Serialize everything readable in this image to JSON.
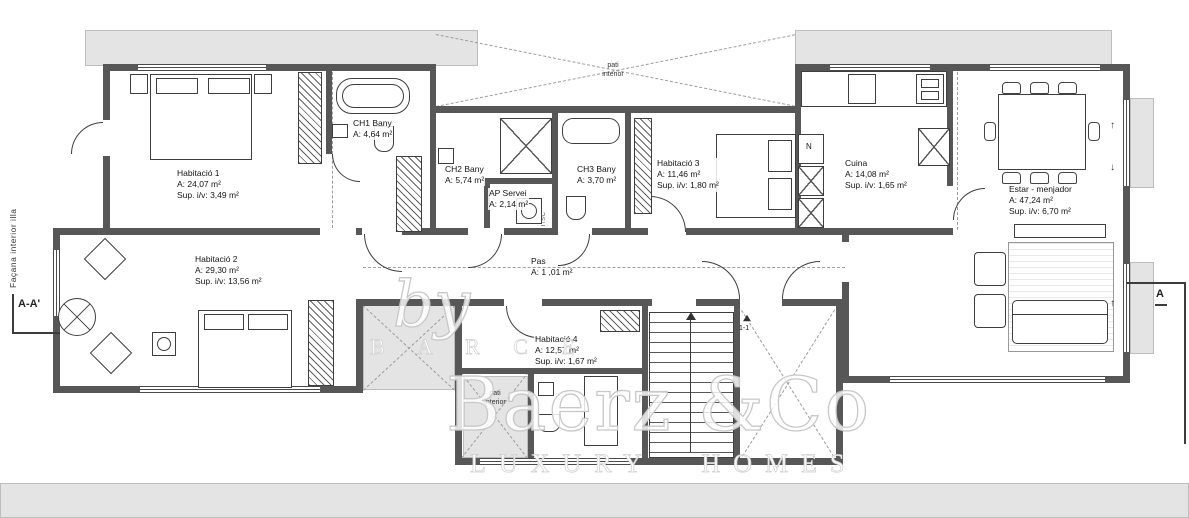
{
  "plan": {
    "rooms": [
      {
        "name": "Habitació 1",
        "area": "A: 24,07 m²",
        "supiv": "Sup. i/v: 3,49 m²"
      },
      {
        "name": "CH1 Bany",
        "area": "A: 4,64 m²"
      },
      {
        "name": "CH2 Bany",
        "area": "A: 5,74 m²"
      },
      {
        "name": "AP Servei",
        "area": "A: 2,14 m²"
      },
      {
        "name": "CH3 Bany",
        "area": "A: 3,70 m²"
      },
      {
        "name": "Habitació 3",
        "area": "A: 11,46 m²",
        "supiv": "Sup. i/v: 1,80 m²"
      },
      {
        "name": "Cuina",
        "area": "A: 14,08 m²",
        "supiv": "Sup. i/v: 1,65 m²"
      },
      {
        "name": "Estar - menjador",
        "area": "A: 47,24 m²",
        "supiv": "Sup. i/v: 6,70 m²"
      },
      {
        "name": "Habitació 2",
        "area": "A: 29,30 m²",
        "supiv": "Sup. i/v: 13,56 m²"
      },
      {
        "name": "Pas",
        "area": "A: 1 ,01 m²"
      },
      {
        "name": "Habitació 4",
        "area": "A: 12,57 m²",
        "supiv": "Sup. i/v: 1,67 m²"
      }
    ],
    "annotations": {
      "facade": "Façana interior illa",
      "section_left": "A-A'",
      "section_right": "A",
      "patio_top_1": "pati",
      "patio_top_2": "interior",
      "patio_small_1": "pati",
      "patio_small_2": "interior",
      "stair_section": "1-1",
      "shaft": "RT/SC",
      "cabinet_n": "N",
      "arrow_up": "↑",
      "arrow_down": "↓"
    },
    "watermark": {
      "by": "by",
      "partner": "B A R C E",
      "brand": "Baerz &Co",
      "tagline": "LUXURY HOMES"
    }
  }
}
